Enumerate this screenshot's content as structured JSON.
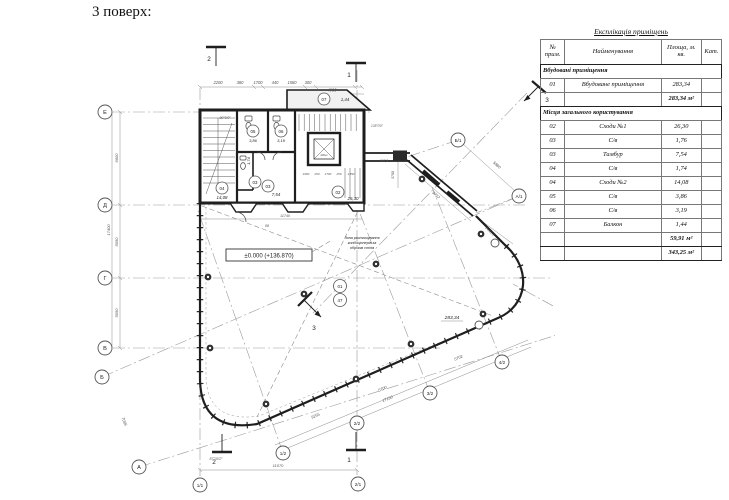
{
  "page": {
    "title": "3 поверх:"
  },
  "table": {
    "title": "Експлікація приміщень",
    "headers": {
      "num": "№ прим.",
      "name": "Найменування",
      "area": "Площа, м. кв.",
      "cat": "Кат."
    },
    "section1": "Вбудовані приміщення",
    "rows1": [
      {
        "num": "01",
        "name": "Вбудоване приміщення",
        "area": "283,34"
      }
    ],
    "subtotal1": "283,34 м²",
    "section2": "Місця загального користування",
    "rows2": [
      {
        "num": "02",
        "name": "Сходи №1",
        "area": "26,30"
      },
      {
        "num": "03",
        "name": "С/в",
        "area": "1,76"
      },
      {
        "num": "03",
        "name": "Тамбур",
        "area": "7,54"
      },
      {
        "num": "04",
        "name": "С/в",
        "area": "1,74"
      },
      {
        "num": "04",
        "name": "Сходи №2",
        "area": "14,08"
      },
      {
        "num": "05",
        "name": "С/в",
        "area": "3,86"
      },
      {
        "num": "06",
        "name": "С/в",
        "area": "3,19"
      },
      {
        "num": "07",
        "name": "Балкон",
        "area": "1,44"
      }
    ],
    "subtotal2": "59,91 м²",
    "total": "343,25 м²"
  },
  "plan": {
    "level_mark": "±0.000 (+136.870)",
    "note_line1": "Зона розташування",
    "note_line2": "кондиціонерів за",
    "note_line3": "обрізом стіни",
    "axis_left": {
      "e": "Е",
      "d": "Д",
      "g": "Г",
      "v": "В",
      "b": "Б",
      "a": "А"
    },
    "axis_bottom": {
      "a11": "1/1",
      "a21": "2/1",
      "a12": "1/2",
      "a22": "2/2",
      "a32": "3/2",
      "a42": "4/2"
    },
    "axis_right": {
      "b1": "Б/1",
      "a1": "А/1",
      "r13": "1/3"
    },
    "rooms": {
      "r01_tag": "01",
      "r01_sub": "47",
      "r01_area": "283,34",
      "r02_tag": "02",
      "r02_area": "26,30",
      "r03a_tag": "03",
      "r03a_area": "1,74",
      "r03b_tag": "03",
      "r03b_area": "7,54",
      "r04_tag": "04",
      "r04_area": "14,08",
      "r05_tag": "05",
      "r05_area": "3,86",
      "r06_tag": "06",
      "r06_area": "3,19",
      "r07_tag": "07",
      "r07_area": "1,44"
    },
    "sections": {
      "s1": "1",
      "s2": "2",
      "s3": "3"
    },
    "dims": {
      "top": [
        "2200",
        "380",
        "1700",
        "440",
        "1580",
        "300",
        "4900"
      ],
      "left_total": "17400",
      "left_1": "6600",
      "left_2": "5050",
      "left_3": "5050",
      "bottom_h": "11070",
      "bottom_d1": "9255",
      "bottom_d2": "17190",
      "bottom_d3": "5700",
      "bottom_d4": "5702",
      "right_1": "5880",
      "right_2": "9737",
      "right_3": "2440,3",
      "right_4": "3700",
      "right_5": "867,8",
      "core_w": "11740",
      "ba": "7085",
      "door": "08",
      "lift": "400кг",
      "stair": [
        "1060",
        "250",
        "1700",
        "250",
        "1350"
      ]
    },
    "angles": {
      "a90": "90°0'0\"",
      "a87": "87°30'2\"",
      "a60": "60°0'0\"",
      "a135": "135°0'0\""
    }
  }
}
